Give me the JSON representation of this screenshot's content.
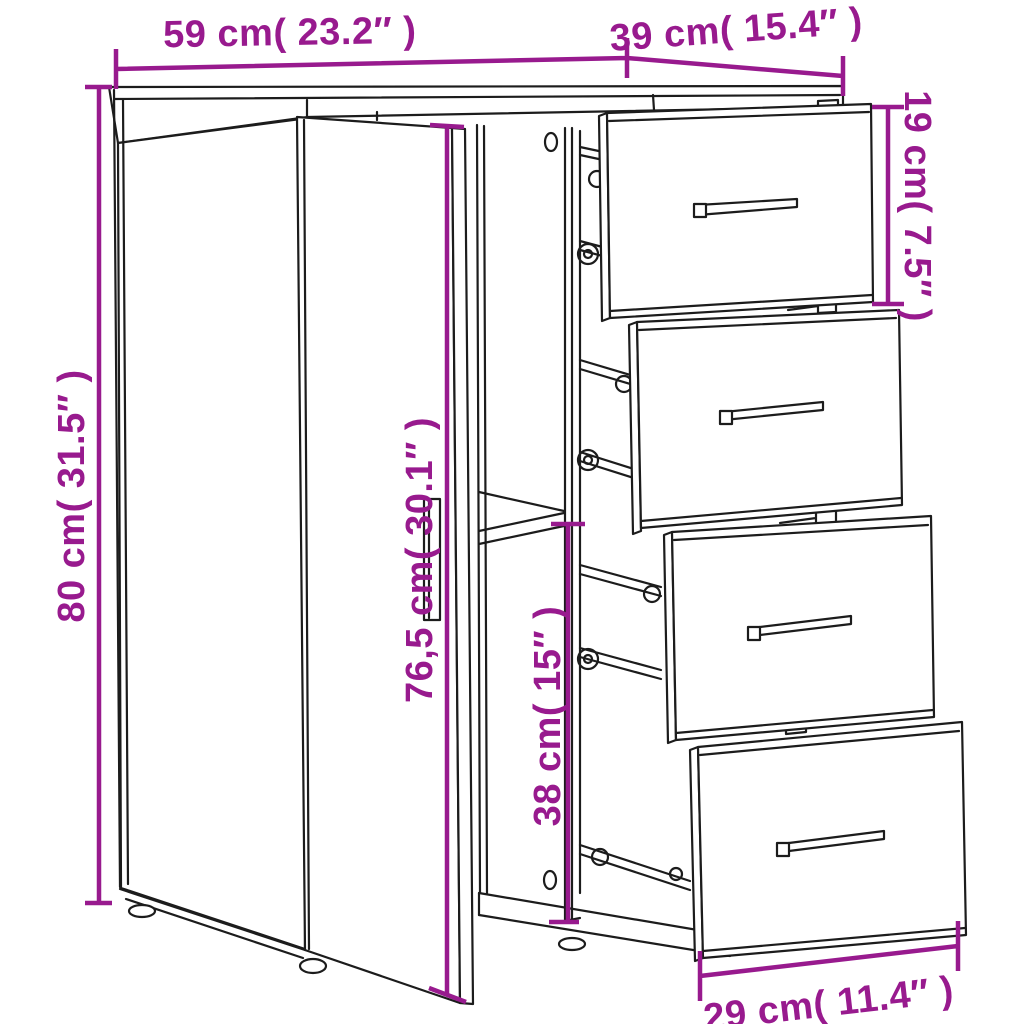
{
  "page": {
    "title": "Sideboard dimension diagram",
    "background": "#ffffff"
  },
  "diagram": {
    "subject": "sideboard with hinged left door and four pull-out drawers, line drawing with dimension callouts",
    "colors": {
      "dimension_accent": "#981a8e",
      "line": "#1c1c1c",
      "background": "#ffffff"
    },
    "dimensions": {
      "overall_width": {
        "label": "59 cm( 23.2″ )",
        "cm": 59,
        "inches": 23.2
      },
      "overall_depth": {
        "label": "39 cm( 15.4″ )",
        "cm": 39,
        "inches": 15.4
      },
      "overall_height": {
        "label": "80 cm( 31.5″ )",
        "cm": 80,
        "inches": 31.5
      },
      "drawer_front_height": {
        "label": "19 cm( 7.5″ )",
        "cm": 19,
        "inches": 7.5
      },
      "door_height": {
        "label": "76,5 cm( 30.1″ )",
        "cm": 76.5,
        "inches": 30.1
      },
      "lower_compartment_height": {
        "label": "38 cm( 15″ )",
        "cm": 38,
        "inches": 15
      },
      "drawer_front_width": {
        "label": "29 cm( 11.4″ )",
        "cm": 29,
        "inches": 11.4
      }
    }
  }
}
